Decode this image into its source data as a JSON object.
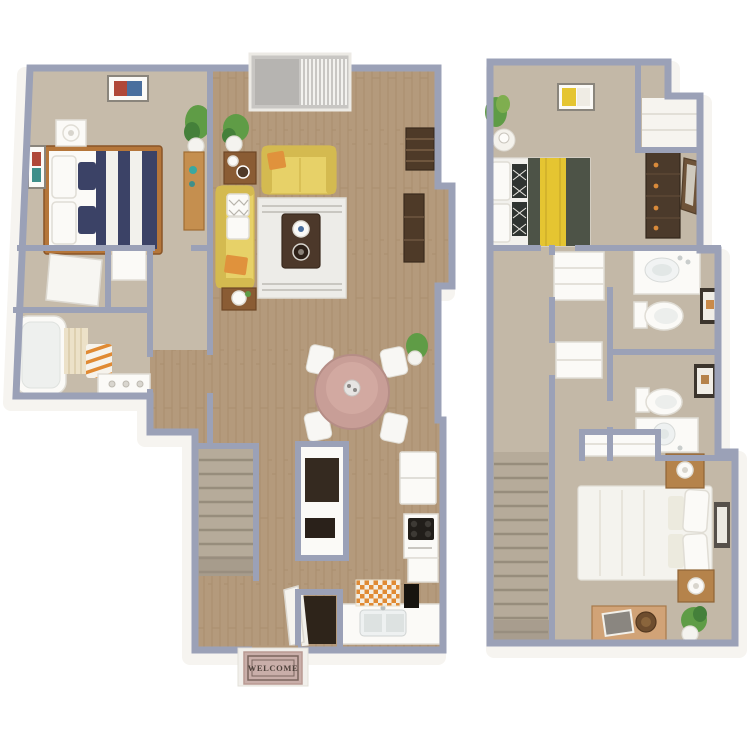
{
  "mat": {
    "text": "WELCOME"
  },
  "colors": {
    "wallCap": "#9ba1b7",
    "wallFace": "#f6f4f0",
    "carpet1": "#c6bbaa",
    "carpet2": "#c3b8a7",
    "wood": "#b49a7c",
    "woodLine": "#a0835f",
    "stairs": "#b6ab9a",
    "stairLine": "#978d7c",
    "sofaYellow": "#e7d168",
    "sofaYellowDk": "#d4ba50",
    "orangeAccent": "#e0923c",
    "navy": "#3b4266",
    "bedFrame": "#b5763a",
    "white": "#fbfaf7",
    "whiteShade": "#e0ddd5",
    "tableDark": "#4c382a",
    "consoleBrown": "#4e3a28",
    "deskTan": "#c58f4f",
    "diningPink": "#c89e97",
    "chairWhite": "#f8f7f4",
    "oliveBed": "#4d5347",
    "yellowThrow": "#e5c531",
    "dresserBrown": "#4b3a2b",
    "basin": "#eef1f1",
    "tileOrange": "#e08a33",
    "cream": "#f3eee3",
    "plantGreen": "#5f9c46",
    "plantDark": "#44803a",
    "potWhite": "#f4f3ef",
    "matPink": "#c9aea9",
    "matBorder": "#7a655e",
    "matText": "#4f423c",
    "stepWhite": "#f1efeb",
    "nightTan": "#b5834b"
  },
  "floor1": {
    "label": "first-floor",
    "rooms": [
      "bedroom",
      "closets",
      "bathroom",
      "hallway",
      "living-room",
      "dining-area",
      "kitchen",
      "stairs",
      "entry"
    ]
  },
  "floor2": {
    "label": "second-floor",
    "rooms": [
      "bedroom",
      "hallway",
      "linen-closets",
      "bathroom-1",
      "bathroom-2",
      "stairs",
      "bedroom-2"
    ]
  }
}
